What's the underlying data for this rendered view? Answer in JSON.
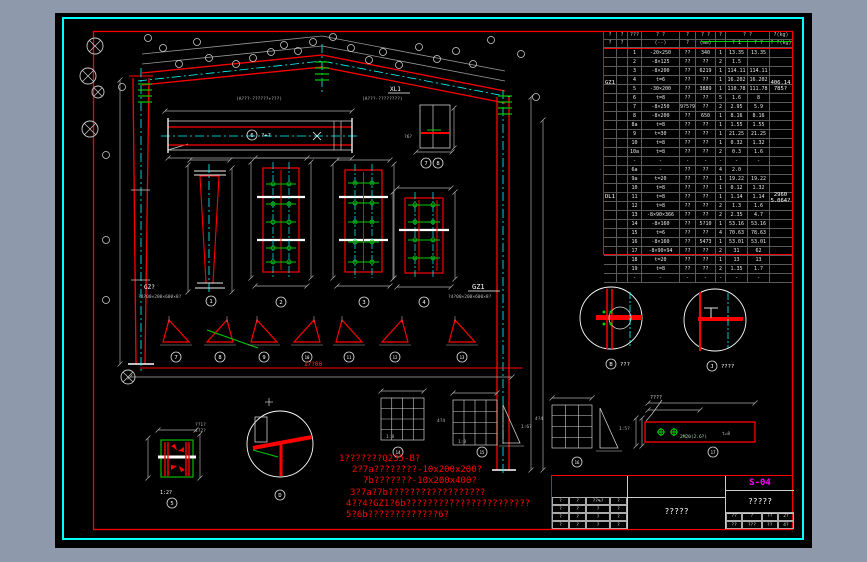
{
  "colors": {
    "background": "#8e9aab",
    "canvas": "#000000",
    "border_cyan": "#00ffff",
    "frame_red": "#ff0000",
    "accent_green": "#00cc00",
    "highlight_magenta": "#ff00ff"
  },
  "drawing": {
    "labels": {
      "gz1": "GZ1",
      "gz1_sub": "?4?00×200×600×8?",
      "gz_left": "GZ?",
      "gz_left_sub": "?4?00×200×600×8?",
      "xl1": "XL1",
      "note_a1": "(A???·??????+???)",
      "note_a2": "(A???·????????)",
      "scale_12": "1:2?",
      "g1_scale": "1:8",
      "g2_scale": "1:8",
      "t2_scale": "1:6?",
      "t3_scale": "1:5?",
      "g2_dim": "4?4",
      "g3_dim": "4?4",
      "redbar_label": "????",
      "redbar_bolt": "2M20(2.6?)",
      "redbar_t": "t=8",
      "span_dim": "17?00",
      "phi": "?6?",
      "h_dim1": "??1?",
      "h_dim2": "4?2?"
    },
    "captions": [
      {
        "x": 211,
        "y": 301,
        "c": "1",
        "label": ""
      },
      {
        "x": 281,
        "y": 302,
        "c": "2",
        "label": ""
      },
      {
        "x": 364,
        "y": 302,
        "c": "3",
        "label": ""
      },
      {
        "x": 424,
        "y": 302,
        "c": "4",
        "label": ""
      },
      {
        "x": 252,
        "y": 135,
        "c": "6",
        "label": "?+?"
      },
      {
        "x": 176,
        "y": 357,
        "c": "7",
        "label": ""
      },
      {
        "x": 220,
        "y": 357,
        "c": "8",
        "label": ""
      },
      {
        "x": 264,
        "y": 357,
        "c": "9",
        "label": ""
      },
      {
        "x": 307,
        "y": 357,
        "c": "10",
        "label": ""
      },
      {
        "x": 349,
        "y": 357,
        "c": "11",
        "label": ""
      },
      {
        "x": 395,
        "y": 357,
        "c": "12",
        "label": ""
      },
      {
        "x": 462,
        "y": 357,
        "c": "13",
        "label": ""
      },
      {
        "x": 398,
        "y": 452,
        "c": "14",
        "label": ""
      },
      {
        "x": 482,
        "y": 452,
        "c": "15",
        "label": ""
      },
      {
        "x": 577,
        "y": 462,
        "c": "16",
        "label": ""
      },
      {
        "x": 713,
        "y": 452,
        "c": "17",
        "label": ""
      },
      {
        "x": 172,
        "y": 503,
        "c": "5",
        "label": ""
      },
      {
        "x": 280,
        "y": 495,
        "c": "D",
        "label": ""
      },
      {
        "x": 611,
        "y": 364,
        "c": "B",
        "label": "???"
      },
      {
        "x": 712,
        "y": 366,
        "c": "J",
        "label": "????"
      },
      {
        "x": 426,
        "y": 163,
        "c": "7",
        "label": ""
      },
      {
        "x": 438,
        "y": 163,
        "c": "8",
        "label": ""
      }
    ]
  },
  "notes": {
    "lines": [
      "1???????Q235-B?",
      "2?7a????????-10x200x200?",
      "7b???????-10x200x400?",
      "3?7a?7b??????????????????",
      "4??4?GZ1?6b???????????????????????",
      "5?6b?????????????6?"
    ]
  },
  "parts_table": {
    "header_row1": [
      "?",
      "?",
      "???",
      "? ?",
      "?",
      "? ?",
      "?",
      "? ?",
      "?(kg)"
    ],
    "header_row2": [
      "?",
      "?",
      "",
      "(--)",
      "?",
      "(mm)",
      "",
      "? 1",
      "? ?",
      "? ?(kg)"
    ],
    "groups": [
      {
        "label": "GZ1",
        "total": "406.14",
        "total2": "785?",
        "rows": [
          [
            "1",
            "-20×250",
            "??",
            "340",
            "1",
            "13.35",
            "13.35"
          ],
          [
            "2",
            "-8×125",
            "??",
            "??",
            "2",
            "1.5",
            ""
          ],
          [
            "3",
            "-8×200",
            "??",
            "6219",
            "1",
            "114.11",
            "114.11"
          ],
          [
            "4",
            "t=6",
            "??",
            "??",
            "1",
            "16.202",
            "16.202"
          ],
          [
            "5",
            "-30×200",
            "??",
            "3889",
            "1",
            "110.78",
            "111.78"
          ],
          [
            "6",
            "t=8",
            "??",
            "??",
            "5",
            "1.6",
            "8"
          ],
          [
            "7",
            "-8×250",
            "9?5?9",
            "??",
            "2",
            "2.95",
            "5.9"
          ],
          [
            "8",
            "-8×200",
            "??",
            "650",
            "1",
            "8.16",
            "8.16"
          ],
          [
            "8a",
            "t=8",
            "??",
            "??",
            "1",
            "1.55",
            "1.55"
          ],
          [
            "9",
            "t=30",
            "??",
            "??",
            "1",
            "21.25",
            "21.25"
          ],
          [
            "10",
            "t=8",
            "??",
            "??",
            "1",
            "0.32",
            "1.32"
          ],
          [
            "10a",
            "t=8",
            "??",
            "??",
            "2",
            "0.3",
            "1.6"
          ],
          [
            "-",
            "-",
            "-",
            "-",
            "-",
            "-",
            "-"
          ]
        ]
      },
      {
        "label": "DL1",
        "total": "2960",
        "total2": "5.064?",
        "rows": [
          [
            "6a",
            "-",
            "??",
            "??",
            "4",
            "2.0",
            ""
          ],
          [
            "9a",
            "t=20",
            "??",
            "??",
            "1",
            "19.22",
            "19.22"
          ],
          [
            "10",
            "t=8",
            "??",
            "??",
            "1",
            "0.12",
            "1.32"
          ],
          [
            "11",
            "t=8",
            "??",
            "??",
            "1",
            "1.14",
            "1.14"
          ],
          [
            "12",
            "t=8",
            "??",
            "??",
            "2",
            "1.3",
            "1.6"
          ],
          [
            "13",
            "-8×90×366",
            "??",
            "??",
            "2",
            "2.35",
            "4.7"
          ],
          [
            "14",
            "-8×160",
            "??",
            "5?10",
            "1",
            "53.16",
            "53.16"
          ],
          [
            "15",
            "t=6",
            "??",
            "??",
            "4",
            "70.63",
            "78.63"
          ],
          [
            "16",
            "-8×160",
            "??",
            "5473",
            "1",
            "53.01",
            "53.01"
          ],
          [
            "17",
            "-8×90×94",
            "??",
            "??",
            "2",
            "31",
            "62"
          ],
          [
            "18",
            "t=20",
            "??",
            "??",
            "1",
            "13",
            "13"
          ],
          [
            "19",
            "t=8",
            "??",
            "??",
            "2",
            "1.35",
            "1.7"
          ],
          [
            "-",
            "-",
            "-",
            "-",
            "-",
            "-",
            "-"
          ]
        ]
      }
    ]
  },
  "title_block": {
    "drawing_no": "S-04",
    "title": "?????",
    "project": "?????",
    "revision_rows": [
      [
        "?",
        "?",
        "??%?",
        "?"
      ],
      [
        "?",
        "?",
        "?",
        "?"
      ],
      [
        "?",
        "?",
        "?",
        "?"
      ],
      [
        "?",
        "?",
        "?",
        "?"
      ]
    ],
    "bottom_rows": [
      [
        "??",
        "?",
        "??",
        "2?"
      ],
      [
        "??",
        "???",
        "??",
        "4?"
      ]
    ]
  }
}
